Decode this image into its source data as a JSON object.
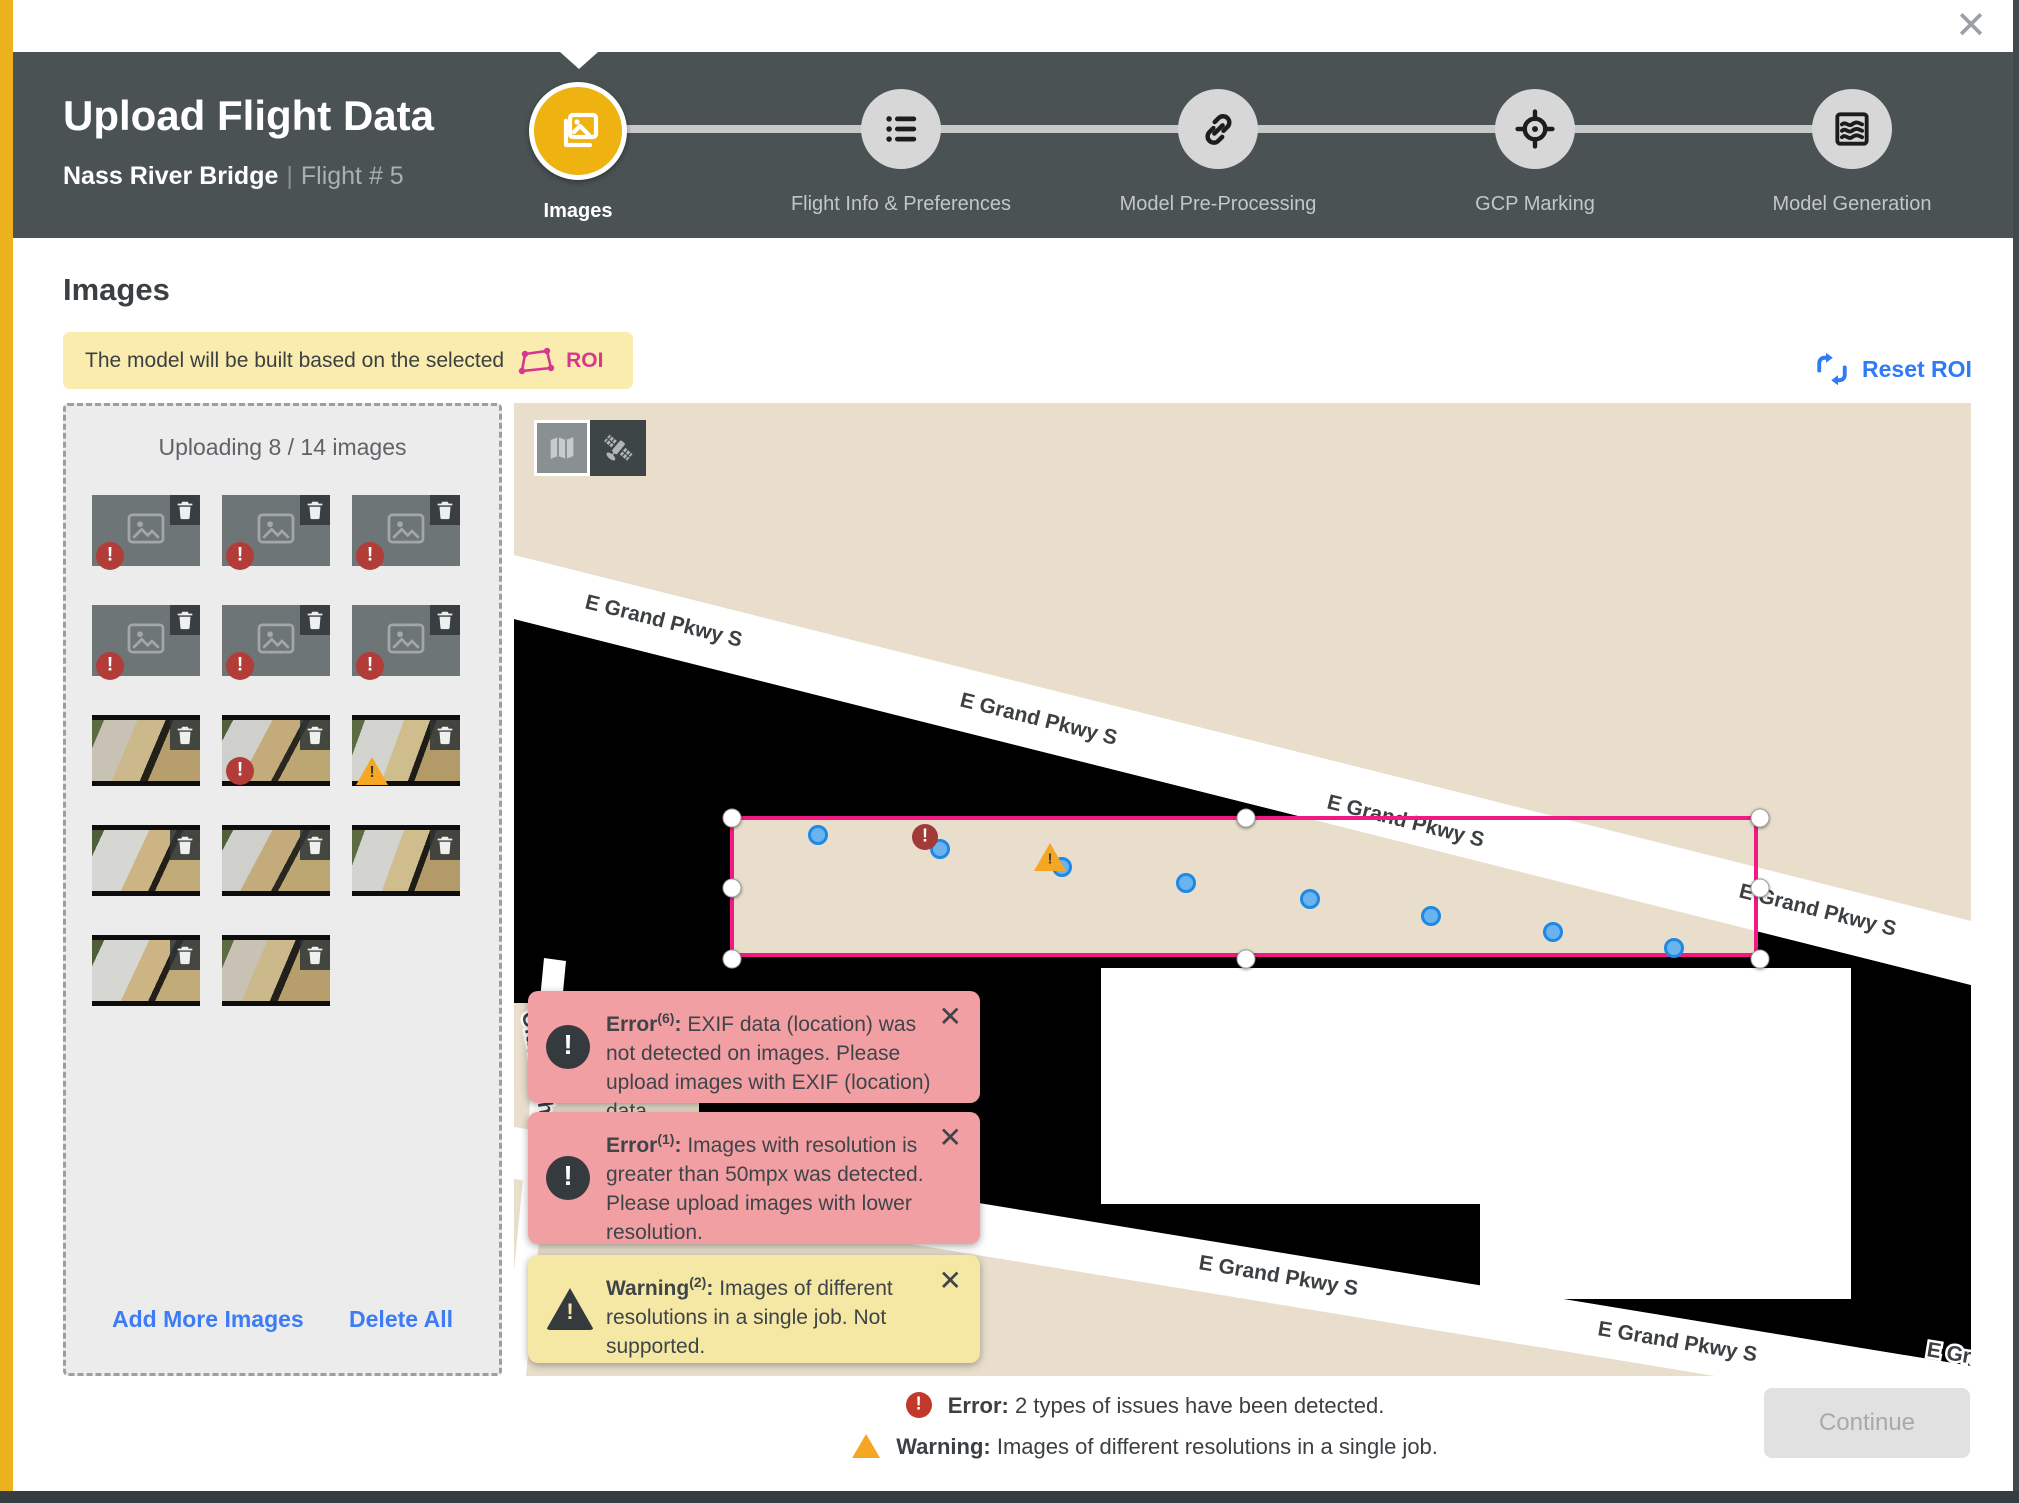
{
  "window": {
    "close_icon": "✕"
  },
  "header": {
    "title": "Upload Flight Data",
    "project": "Nass River Bridge",
    "separator": "|",
    "flight": "Flight # 5"
  },
  "stepper": {
    "steps": [
      {
        "label": "Images",
        "state": "active"
      },
      {
        "label": "Flight Info & Preferences",
        "state": "upcoming"
      },
      {
        "label": "Model Pre-Processing",
        "state": "upcoming"
      },
      {
        "label": "GCP Marking",
        "state": "upcoming"
      },
      {
        "label": "Model Generation",
        "state": "upcoming"
      }
    ]
  },
  "content": {
    "heading": "Images"
  },
  "banner": {
    "text": "The model will be built based on the selected",
    "roi_label": "ROI"
  },
  "reset_roi": {
    "label": "Reset ROI"
  },
  "upload_panel": {
    "title": "Uploading 8 / 14 images",
    "add_label": "Add More Images",
    "delete_label": "Delete All",
    "thumbnails": [
      {
        "kind": "placeholder",
        "badge": "error"
      },
      {
        "kind": "placeholder",
        "badge": "error"
      },
      {
        "kind": "placeholder",
        "badge": "error"
      },
      {
        "kind": "placeholder",
        "badge": "error"
      },
      {
        "kind": "placeholder",
        "badge": "error"
      },
      {
        "kind": "placeholder",
        "badge": "error"
      },
      {
        "kind": "photo",
        "badge": null,
        "variant": 0
      },
      {
        "kind": "photo",
        "badge": "error",
        "variant": 1
      },
      {
        "kind": "photo",
        "badge": "warning",
        "variant": 2
      },
      {
        "kind": "photo",
        "badge": null,
        "variant": 3
      },
      {
        "kind": "photo",
        "badge": null,
        "variant": 1
      },
      {
        "kind": "photo",
        "badge": null,
        "variant": 2
      },
      {
        "kind": "photo",
        "badge": null,
        "variant": 3
      },
      {
        "kind": "photo",
        "badge": null,
        "variant": 0
      }
    ]
  },
  "map": {
    "view_toggle": {
      "map_button": "map view",
      "satellite_button": "satellite view"
    },
    "colors": {
      "land": "#e8decb",
      "no_data": "#000000",
      "road": "#ffffff",
      "roi": "#ef1a83"
    },
    "road_labels": [
      {
        "text": "E Grand Pkwy S",
        "x": 70,
        "y": 205,
        "rot": 14
      },
      {
        "text": "E Grand Pkwy S",
        "x": 445,
        "y": 303,
        "rot": 14
      },
      {
        "text": "E Grand Pkwy S",
        "x": 812,
        "y": 405,
        "rot": 14
      },
      {
        "text": "E Grand Pkwy S",
        "x": 1224,
        "y": 494,
        "rot": 14
      },
      {
        "text": "E Grand Pkwy S",
        "x": 684,
        "y": 866,
        "rot": 9.5
      },
      {
        "text": "E Grand Pkwy S",
        "x": 1083,
        "y": 932,
        "rot": 9.5
      },
      {
        "text": "E Gra",
        "x": 1412,
        "y": 953,
        "rot": 9.5
      },
      {
        "text": "Old Beach Rd",
        "x": 8,
        "y": 610,
        "rot": 80
      }
    ],
    "camera_points": [
      {
        "x": 84,
        "y": 15
      },
      {
        "x": 206,
        "y": 29
      },
      {
        "x": 328,
        "y": 47
      },
      {
        "x": 452,
        "y": 63
      },
      {
        "x": 576,
        "y": 79
      },
      {
        "x": 697,
        "y": 96
      },
      {
        "x": 819,
        "y": 112
      },
      {
        "x": 940,
        "y": 128
      }
    ]
  },
  "toasts": [
    {
      "type": "error",
      "label": "Error",
      "count": "(6)",
      "sep": ":",
      "text": "EXIF data (location) was not detected on images. Please upload images with EXIF (location) data.",
      "close_icon": "✕"
    },
    {
      "type": "error",
      "label": "Error",
      "count": "(1)",
      "sep": ":",
      "text": "Images with resolution is greater than 50mpx was detected. Please upload images with lower resolution.",
      "close_icon": "✕"
    },
    {
      "type": "warning",
      "label": "Warning",
      "count": "(2)",
      "sep": ":",
      "text": "Images of different resolutions in a single job. Not supported.",
      "close_icon": "✕"
    }
  ],
  "footer": {
    "error_label": "Error:",
    "error_text": "2 types of issues have been detected.",
    "warning_label": "Warning:",
    "warning_text": "Images of different resolutions in a single job.",
    "continue_label": "Continue"
  }
}
